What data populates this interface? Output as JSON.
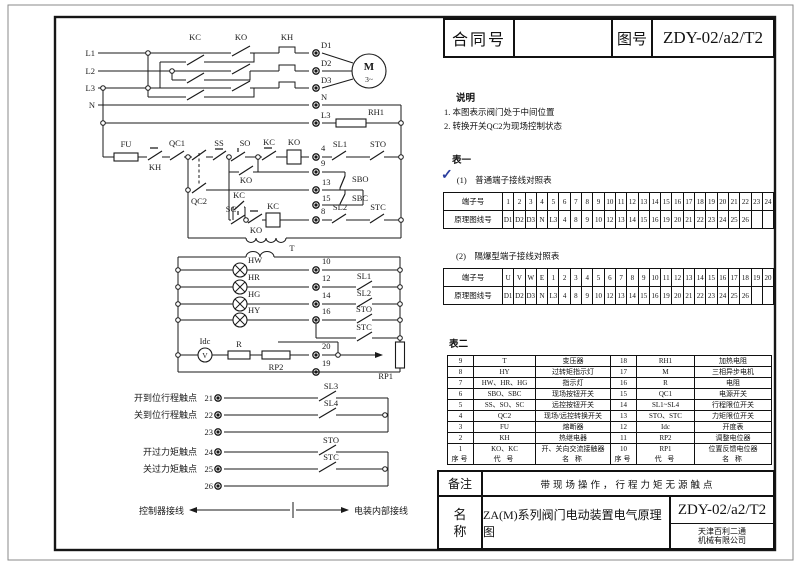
{
  "colors": {
    "line": "#1a1a1a",
    "check_mark": "#2b3f9f"
  },
  "title_block": {
    "contract_label": "合同号",
    "contract_value": "",
    "drawing_no_label": "图号",
    "drawing_no": "ZDY-02/a2/T2"
  },
  "notes": {
    "heading": "说明",
    "item1": "1. 本图表示阀门处于中间位置",
    "item2": "2. 转换开关QC2为现场控制状态"
  },
  "table1": {
    "caption": "表一",
    "check_mark": "✓",
    "sub1_title": "(1)　普通端子接线对照表",
    "sub2_title": "(2)　隔爆型端子接线对照表",
    "row_header_terminal": "端子号",
    "row_header_line": "原理图线号",
    "ordinary_terminals": [
      "1",
      "2",
      "3",
      "4",
      "5",
      "6",
      "7",
      "8",
      "9",
      "10",
      "11",
      "12",
      "13",
      "14",
      "15",
      "16",
      "17",
      "18",
      "19",
      "20",
      "21",
      "22",
      "23",
      "24"
    ],
    "flameproof_terminals": [
      "U",
      "V",
      "W",
      "E",
      "1",
      "2",
      "3",
      "4",
      "5",
      "6",
      "7",
      "8",
      "9",
      "10",
      "11",
      "12",
      "13",
      "14",
      "15",
      "16",
      "17",
      "18",
      "19",
      "20"
    ],
    "line_numbers": [
      "D1",
      "D2",
      "D3",
      "N",
      "L3",
      "4",
      "8",
      "9",
      "10",
      "12",
      "13",
      "14",
      "15",
      "16",
      "19",
      "20",
      "21",
      "22",
      "23",
      "24",
      "25",
      "26",
      "",
      ""
    ]
  },
  "table2": {
    "caption": "表二",
    "header": [
      "序号",
      "代 号",
      "名 称",
      "序号",
      "代 号",
      "名 称"
    ],
    "rows": [
      [
        "9",
        "T",
        "变压器",
        "18",
        "RH1",
        "加热电阻"
      ],
      [
        "8",
        "HY",
        "过转矩指示灯",
        "17",
        "M",
        "三相异步电机"
      ],
      [
        "7",
        "HW、HR、HG",
        "指示灯",
        "16",
        "R",
        "电阻"
      ],
      [
        "6",
        "SBO、SBC",
        "现场按钮开关",
        "15",
        "QC1",
        "电源开关"
      ],
      [
        "5",
        "SS、SO、SC",
        "远控按钮开关",
        "14",
        "SL1~SL4",
        "行程限位开关"
      ],
      [
        "4",
        "QC2",
        "现场/远控转换开关",
        "13",
        "STO、STC",
        "力矩限位开关"
      ],
      [
        "3",
        "FU",
        "熔断器",
        "12",
        "Idc",
        "开度表"
      ],
      [
        "2",
        "KH",
        "热继电器",
        "11",
        "RP2",
        "调整电位器"
      ],
      [
        "1",
        "KO、KC",
        "开、关向交流接触器",
        "10",
        "RP1",
        "位置反馈电位器"
      ]
    ]
  },
  "footer": {
    "remark_label": "备注",
    "remark_text": "带现场操作，行程力矩无源触点",
    "name_label_1": "名",
    "name_label_2": "称",
    "name_text": "ZA(M)系列阀门电动装置电气原理图",
    "drawing_no": "ZDY-02/a2/T2",
    "company_line1": "天津百利二通",
    "company_line2": "机械有限公司"
  },
  "circuit": {
    "phase_l1": "L1",
    "phase_l2": "L2",
    "phase_l3": "L3",
    "neutral": "N",
    "kc": "KC",
    "ko": "KO",
    "kh": "KH",
    "d1": "D1",
    "d2": "D2",
    "d3": "D3",
    "l3_term": "L3",
    "rh1": "RH1",
    "motor": "M",
    "motor_phase": "3~",
    "fu": "FU",
    "qc1": "QC1",
    "qc2": "QC2",
    "ss": "SS",
    "so": "SO",
    "sc": "SC",
    "sbo": "SBO",
    "sbc": "SBC",
    "sl1": "SL1",
    "sl2": "SL2",
    "sl3": "SL3",
    "sl4": "SL4",
    "sto": "STO",
    "stc": "STC",
    "t": "T",
    "hw": "HW",
    "hr": "HR",
    "hg": "HG",
    "hy": "HY",
    "idc": "Idc",
    "v": "V",
    "r": "R",
    "rp1": "RP1",
    "rp2": "RP2",
    "n4": "4",
    "n8": "8",
    "n9": "9",
    "n13": "13",
    "n15": "15",
    "n10": "10",
    "n12": "12",
    "n14": "14",
    "n16": "16",
    "n19": "19",
    "n20": "20",
    "n21": "21",
    "n22": "22",
    "n23": "23",
    "n24": "24",
    "n25": "25",
    "n26": "26",
    "open_travel_contact": "开到位行程触点",
    "close_travel_contact": "关到位行程触点",
    "open_torque_contact": "开过力矩触点",
    "close_torque_contact": "关过力矩触点",
    "controller_wiring": "控制器接线",
    "internal_wiring": "电装内部接线"
  }
}
